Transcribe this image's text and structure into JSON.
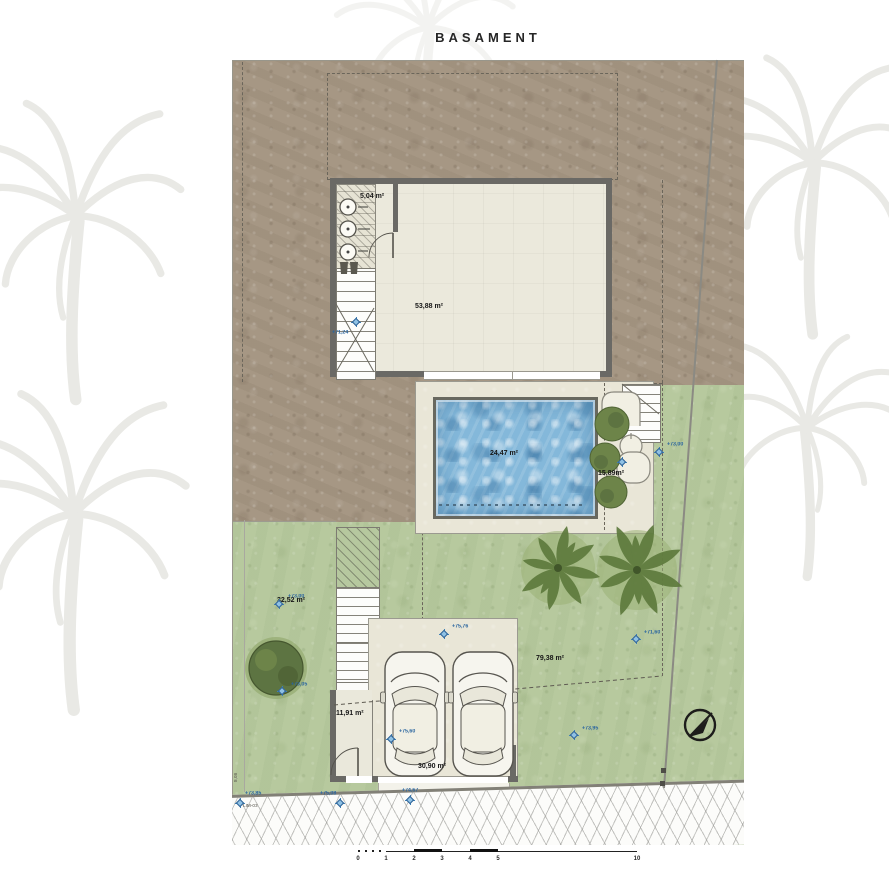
{
  "title": "BASAMENT",
  "plan": {
    "rooms": [
      {
        "id": "utility-room",
        "label": "5,04 m²"
      },
      {
        "id": "basement-room",
        "label": "53,88 m²"
      },
      {
        "id": "pool",
        "label": "24,47 m²"
      },
      {
        "id": "pool-terrace",
        "label": "15,89m²"
      },
      {
        "id": "garden-left",
        "label": "32,52 m²"
      },
      {
        "id": "garden-right",
        "label": "79,38 m²"
      },
      {
        "id": "garage",
        "label": "30,90 m²"
      },
      {
        "id": "entry-room",
        "label": "11,91 m²"
      }
    ],
    "elevation_markers": [
      {
        "label": "+71,24",
        "x": 356,
        "y": 322,
        "tx": -24,
        "ty": 8
      },
      {
        "label": "+73,00",
        "x": 659,
        "y": 452,
        "tx": 8,
        "ty": -10
      },
      {
        "label": "+73,00",
        "x": 279,
        "y": 604,
        "tx": 9,
        "ty": -10
      },
      {
        "label": "+73,05",
        "x": 282,
        "y": 691,
        "tx": 9,
        "ty": -9
      },
      {
        "label": "+75,76",
        "x": 444,
        "y": 634,
        "tx": 8,
        "ty": -10
      },
      {
        "label": "+71,60",
        "x": 636,
        "y": 639,
        "tx": 8,
        "ty": -9
      },
      {
        "label": "+73,95",
        "x": 574,
        "y": 735,
        "tx": 8,
        "ty": -9
      },
      {
        "label": "+75,60",
        "x": 391,
        "y": 739,
        "tx": 8,
        "ty": -10
      },
      {
        "label": "+75,08",
        "x": 340,
        "y": 803,
        "tx": -20,
        "ty": -12
      },
      {
        "label": "+74,67",
        "x": 410,
        "y": 800,
        "tx": -8,
        "ty": -12
      },
      {
        "label": "+73,85",
        "x": 240,
        "y": 803,
        "tx": 5,
        "ty": -12
      },
      {
        "label": "",
        "x": 622,
        "y": 462,
        "tx": 0,
        "ty": 0
      }
    ],
    "boundary_labels": [
      {
        "text": "8,08",
        "x": 234,
        "y": 782,
        "rot": -90
      },
      {
        "text": "LIM-03",
        "x": 243,
        "y": 804,
        "rot": 0
      }
    ]
  },
  "scale_bar": {
    "ticks": [
      {
        "t": "0",
        "x": 358
      },
      {
        "t": "1",
        "x": 386
      },
      {
        "t": "2",
        "x": 414
      },
      {
        "t": "3",
        "x": 442
      },
      {
        "t": "4",
        "x": 470
      },
      {
        "t": "5",
        "x": 498
      },
      {
        "t": "10",
        "x": 637
      }
    ]
  },
  "colors": {
    "dirt": "#a59683",
    "grass": "#b6c89e",
    "pool_water": "#84b8da",
    "wall": "#6a6965",
    "marker_blue": "#3c7fb5"
  }
}
